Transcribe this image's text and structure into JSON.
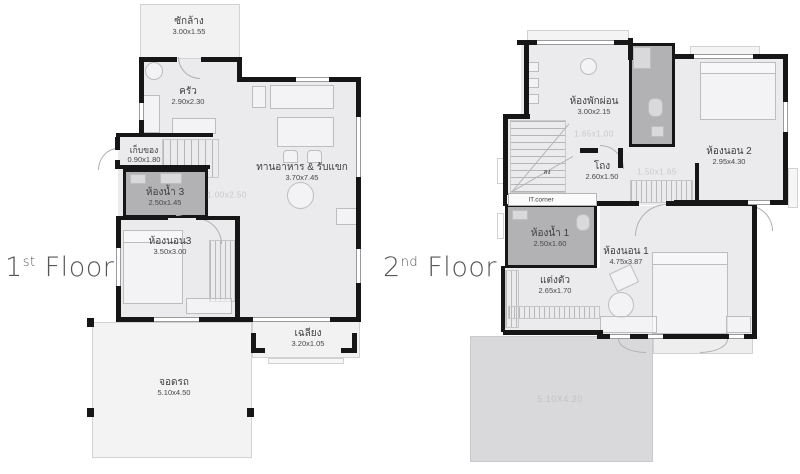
{
  "colors": {
    "wall": "#161616",
    "room_fill": "#ebebed",
    "bathroom_fill": "#b2b2b4",
    "roof_fill": "#d9d9db",
    "outdoor_fill": "#f2f2f3",
    "label_text": "#3e3e40",
    "faint_text": "#c8c8ca",
    "title_text": "#55565a"
  },
  "floors": [
    {
      "title": {
        "number": "1",
        "ordinal": "st",
        "word": "Floor"
      },
      "rooms": {
        "laundry": {
          "name": "ซักล้าง",
          "dim": "3.00x1.55"
        },
        "kitchen": {
          "name": "ครัว",
          "dim": "2.90x2.30"
        },
        "storage": {
          "name": "เก็บของ",
          "dim": "0.90x1.80"
        },
        "bath3": {
          "name": "ห้องน้ำ 3",
          "dim": "2.50x1.45"
        },
        "bed3": {
          "name": "ห้องนอน3",
          "dim": "3.50x3.00"
        },
        "living": {
          "name": "ทานอาหาร & รับแขก",
          "dim": "3.70x7.45"
        },
        "porch": {
          "name": "เฉลียง",
          "dim": "3.20x1.05"
        },
        "carport": {
          "name": "จอดรถ",
          "dim": "5.10x4.50"
        }
      },
      "annotations": {
        "stair_dim": "1.00x2.50"
      }
    },
    {
      "title": {
        "number": "2",
        "ordinal": "nd",
        "word": "Floor"
      },
      "rooms": {
        "family": {
          "name": "ห้องพักผ่อน",
          "dim": "3.00x2.15"
        },
        "hall": {
          "name": "โถง",
          "dim": "2.60x1.50"
        },
        "bed2": {
          "name": "ห้องนอน 2",
          "dim": "2.95x4.30"
        },
        "bath1": {
          "name": "ห้องน้ำ 1",
          "dim": "2.50x1.60"
        },
        "bed1": {
          "name": "ห้องนอน 1",
          "dim": "4.75x3.87"
        },
        "dressing": {
          "name": "แต่งตัว",
          "dim": "2.65x1.70"
        }
      },
      "annotations": {
        "stair_down": "ลง",
        "it_corner": "IT.corner",
        "stair_dim": "1.65x1.00",
        "closet_dim": "1.50x1.65",
        "roof_dim": "5.10X4.20"
      }
    }
  ]
}
